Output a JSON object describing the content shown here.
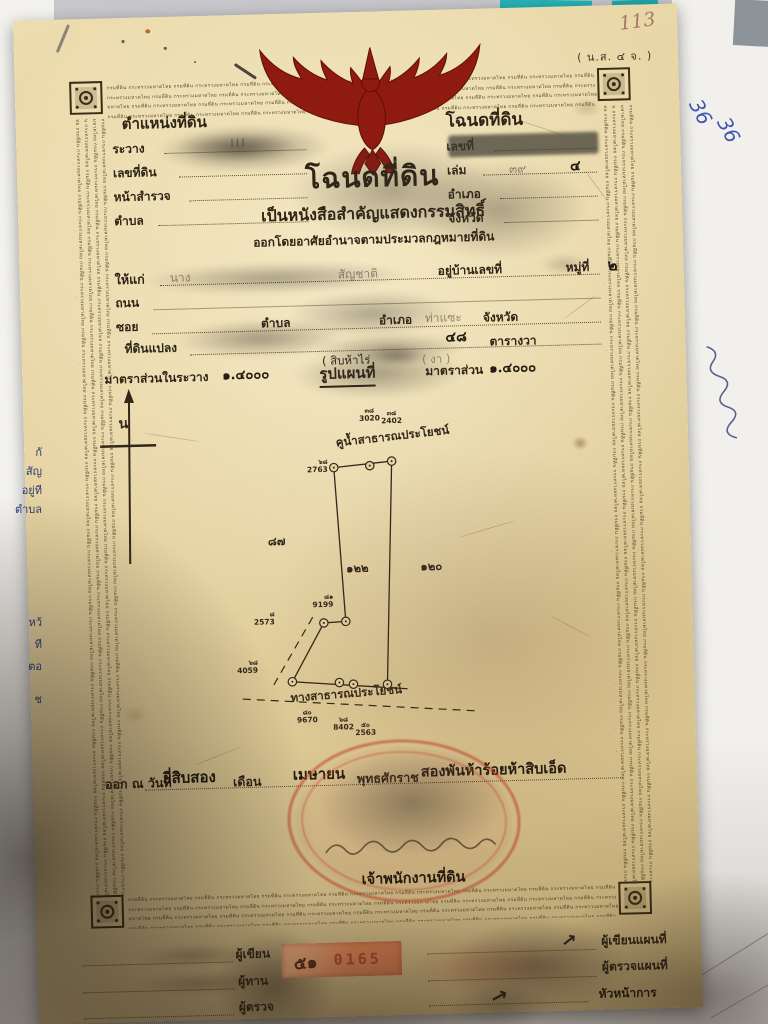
{
  "surface": {
    "note_page_number": "113",
    "blue_notes": [
      "36",
      "36"
    ],
    "left_sheet_fragments": [
      "กั",
      "สัญ",
      "อยู่ที",
      "ตำบล",
      "หว้",
      "ที",
      "ตอ",
      "ช"
    ]
  },
  "deed": {
    "form_code": "( น.ส. ๔ จ. )",
    "border_microtext": "กรมที่ดิน กระทรวงมหาดไทย",
    "heading": {
      "title": "โฉนดที่ดิน",
      "subtitle": "เป็นหนังสือสำคัญแสดงกรรมสิทธิ์",
      "issued_under": "ออกโดยอาศัยอำนาจตามประมวลกฎหมายที่ดิน"
    },
    "position_box": {
      "title": "ตำแหน่งที่ดิน",
      "ravang_label": "ระวาง",
      "ravang_value": "III",
      "land_no_label": "เลขที่ดิน",
      "survey_page_label": "หน้าสำรวจ",
      "tambon_label": "ตำบล"
    },
    "deed_box": {
      "title": "โฉนดที่ดิน",
      "number_label": "เลขที่",
      "volume_label": "เล่ม",
      "volume_value_faint": "๓๙",
      "volume_value": "๔",
      "amphoe_label": "อำเภอ",
      "province_label": "จังหวัด"
    },
    "grantee": {
      "to_label": "ให้แก่",
      "name_visible": "นาง",
      "nationality_label": "สัญชาติ",
      "house_no_label": "อยู่บ้านเลขที่",
      "moo_label": "หมู่ที่",
      "moo_value": "๒",
      "road_label": "ถนน",
      "soi_label": "ซอย",
      "tambon_label": "ตำบล",
      "amphoe_label": "อำเภอ",
      "amphoe_value": "ท่าแซะ",
      "province_label": "จังหวัด"
    },
    "parcel": {
      "plot_label": "ที่ดินแปลง",
      "area_number": "๔๘",
      "area_unit": "ตารางวา",
      "area_words_left": "( สิบห้าไร่",
      "area_words_right": "( งา )"
    },
    "scale": {
      "sheet_scale_label": "มาตราส่วนในระวาง",
      "sheet_scale_value": "๑.๔๐๐๐",
      "map_heading": "รูปแผนที่",
      "map_scale_label": "มาตราส่วน",
      "map_scale_value": "๑.๔๐๐๐"
    },
    "map": {
      "north_label": "น",
      "canal_label": "คูน้ำสาธารณประโยชน์",
      "road_label": "ทางสาธารณประโยชน์",
      "canal_pos": {
        "x": 250,
        "y": 66,
        "r": -5
      },
      "road_pos": {
        "x": 198,
        "y": 320,
        "r": -3
      },
      "parcel_labels": [
        {
          "x": 268,
          "y": 192,
          "t": "๑๒๒"
        },
        {
          "x": 342,
          "y": 192,
          "t": "๑๒๐"
        },
        {
          "x": 188,
          "y": 163,
          "t": "๘๗"
        }
      ],
      "point_labels": [
        {
          "x": 284,
          "y": 33,
          "t": "๓๘",
          "n": "3020",
          "a": "middle"
        },
        {
          "x": 306,
          "y": 36,
          "t": "๓๘",
          "n": "2402",
          "a": "middle"
        },
        {
          "x": 241,
          "y": 83,
          "t": "๖๘",
          "n": "2763",
          "a": "end"
        },
        {
          "x": 243,
          "y": 218,
          "t": "๘๑",
          "n": "9199",
          "a": "end"
        },
        {
          "x": 184,
          "y": 234,
          "t": "๘",
          "n": "2573",
          "a": "end"
        },
        {
          "x": 166,
          "y": 282,
          "t": "๖๘",
          "n": "4059",
          "a": "end"
        },
        {
          "x": 214,
          "y": 333,
          "t": "๘๐",
          "n": "9670",
          "a": "middle"
        },
        {
          "x": 250,
          "y": 341,
          "t": "๖๘",
          "n": "8402",
          "a": "middle"
        },
        {
          "x": 272,
          "y": 347,
          "t": "๕๐",
          "n": "2563",
          "a": "middle"
        }
      ],
      "markers": [
        [
          247,
          87
        ],
        [
          283,
          86
        ],
        [
          305,
          82
        ],
        [
          233,
          242
        ],
        [
          255,
          241
        ],
        [
          200,
          300
        ],
        [
          247,
          302
        ],
        [
          261,
          304
        ],
        [
          295,
          305
        ]
      ],
      "solid_lines": [
        [
          247,
          87,
          305,
          82
        ],
        [
          305,
          82,
          295,
          305
        ],
        [
          247,
          87,
          255,
          241
        ],
        [
          233,
          242,
          255,
          241
        ],
        [
          233,
          242,
          200,
          300
        ],
        [
          200,
          300,
          315,
          310
        ]
      ],
      "dashed_lines": [
        [
          222,
          236,
          180,
          305
        ],
        [
          150,
          316,
          385,
          334
        ]
      ]
    },
    "issue": {
      "prefix": "ออก ณ วันที่",
      "day_value": "ยี่สิบสอง",
      "month_label": "เดือน",
      "month_value": "เมษายน",
      "era_label": "พุทธศักราช",
      "year_value": "สองพันห้าร้อยห้าสิบเอ็ด"
    },
    "officer_title": "เจ้าพนักงานที่ดิน",
    "serial": {
      "book": "๕๑",
      "number": "0165"
    },
    "signoff_left": [
      "ผู้เขียน",
      "ผู้ทาน",
      "ผู้ตรวจ"
    ],
    "signoff_right": [
      "ผู้เขียนแผนที่",
      "ผู้ตรวจแผนที่",
      "หัวหน้าการ"
    ]
  }
}
